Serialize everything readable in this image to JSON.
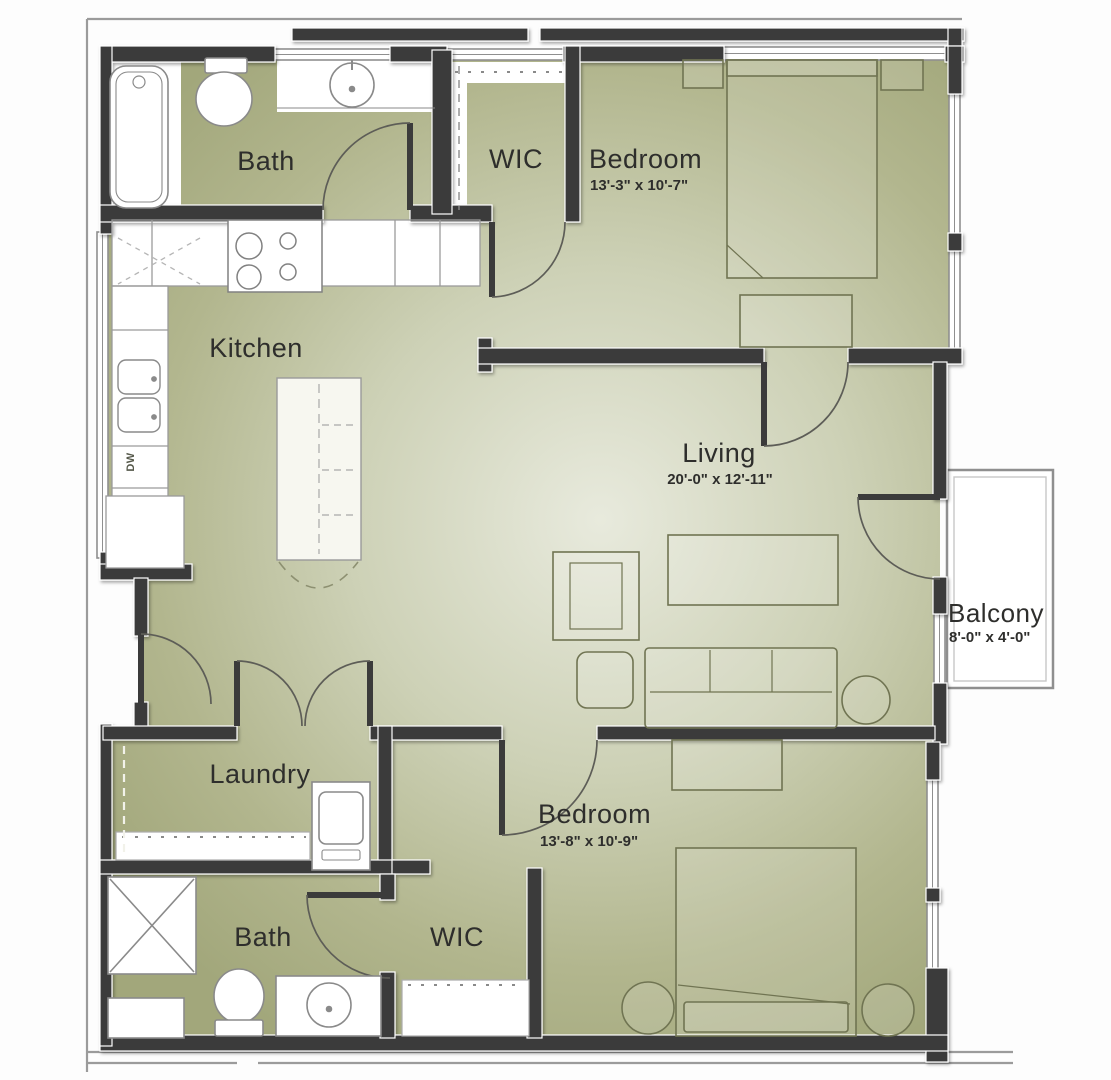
{
  "plan": {
    "title": "Two Bedroom Apartment Floor Plan",
    "rooms": [
      {
        "name": "Bath",
        "dims": "",
        "location": "upper-left"
      },
      {
        "name": "WIC",
        "dims": "",
        "location": "upper-middle"
      },
      {
        "name": "Bedroom",
        "dims": "13'-3\" x 10'-7\"",
        "location": "upper-right"
      },
      {
        "name": "Kitchen",
        "dims": "",
        "location": "mid-left"
      },
      {
        "name": "Living",
        "dims": "20'-0\" x 12'-11\"",
        "location": "center-right"
      },
      {
        "name": "Balcony",
        "dims": "8'-0\" x 4'-0\"",
        "location": "right-exterior"
      },
      {
        "name": "Laundry",
        "dims": "",
        "location": "lower-left"
      },
      {
        "name": "Bedroom",
        "dims": "13'-8\" x 10'-9\"",
        "location": "lower-right"
      },
      {
        "name": "Bath",
        "dims": "",
        "location": "bottom-left"
      },
      {
        "name": "WIC",
        "dims": "",
        "location": "bottom-middle"
      }
    ],
    "annotations": {
      "dishwasher": "DW"
    },
    "colors": {
      "wall": "#3b3b3b",
      "floor_edge": "#a2a77b",
      "floor_center": "#e8eadd",
      "fixture_outline": "#8a8a8a",
      "furniture_outline": "#707452",
      "text": "#2e2e2c"
    }
  }
}
